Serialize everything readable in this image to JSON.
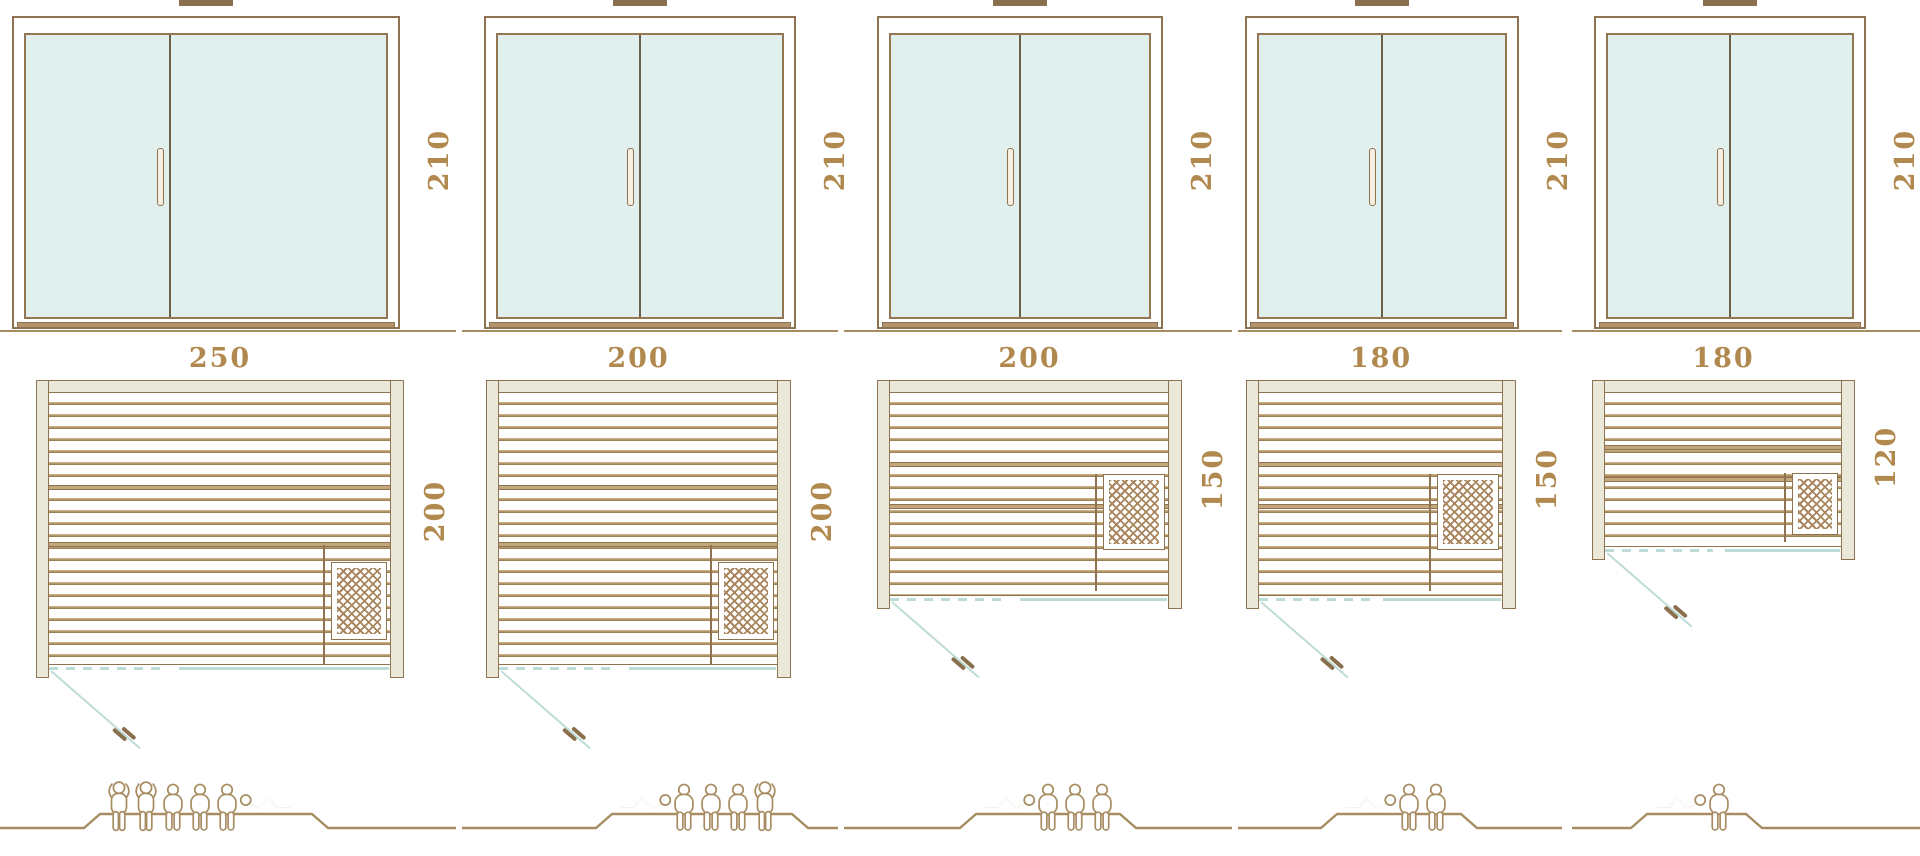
{
  "page": {
    "background": "#ffffff"
  },
  "palette": {
    "line_brown": "#8f7350",
    "dimension_text": "#b1894e",
    "glass_mint": "#e2f0ed",
    "door_swing_teal": "#bedcd7",
    "wood_beige": "#eae8d8",
    "figure_outline": "#a78c62",
    "vent_brown": "#8a6f4c"
  },
  "columns": [
    {
      "door_height_label": "210",
      "plan_width_label": "250",
      "plan_depth_label": "200",
      "heater_position": "bottom-right",
      "capacity": 6,
      "figures": [
        "standing",
        "standing",
        "sitting",
        "sitting",
        "sitting",
        "lying"
      ]
    },
    {
      "door_height_label": "210",
      "plan_width_label": "200",
      "plan_depth_label": "200",
      "heater_position": "bottom-right",
      "capacity": 5,
      "figures": [
        "lying_flip",
        "sitting",
        "sitting",
        "sitting",
        "standing"
      ]
    },
    {
      "door_height_label": "210",
      "plan_width_label": "200",
      "plan_depth_label": "150",
      "heater_position": "middle-right",
      "capacity": 4,
      "figures": [
        "lying_flip",
        "sitting",
        "sitting",
        "sitting"
      ]
    },
    {
      "door_height_label": "210",
      "plan_width_label": "180",
      "plan_depth_label": "150",
      "heater_position": "middle-right",
      "capacity": 3,
      "figures": [
        "lying_flip",
        "sitting",
        "sitting"
      ]
    },
    {
      "door_height_label": "210",
      "plan_width_label": "180",
      "plan_depth_label": "120",
      "heater_position": "middle-right",
      "capacity": 2,
      "figures": [
        "lying_flip",
        "sitting"
      ]
    }
  ]
}
